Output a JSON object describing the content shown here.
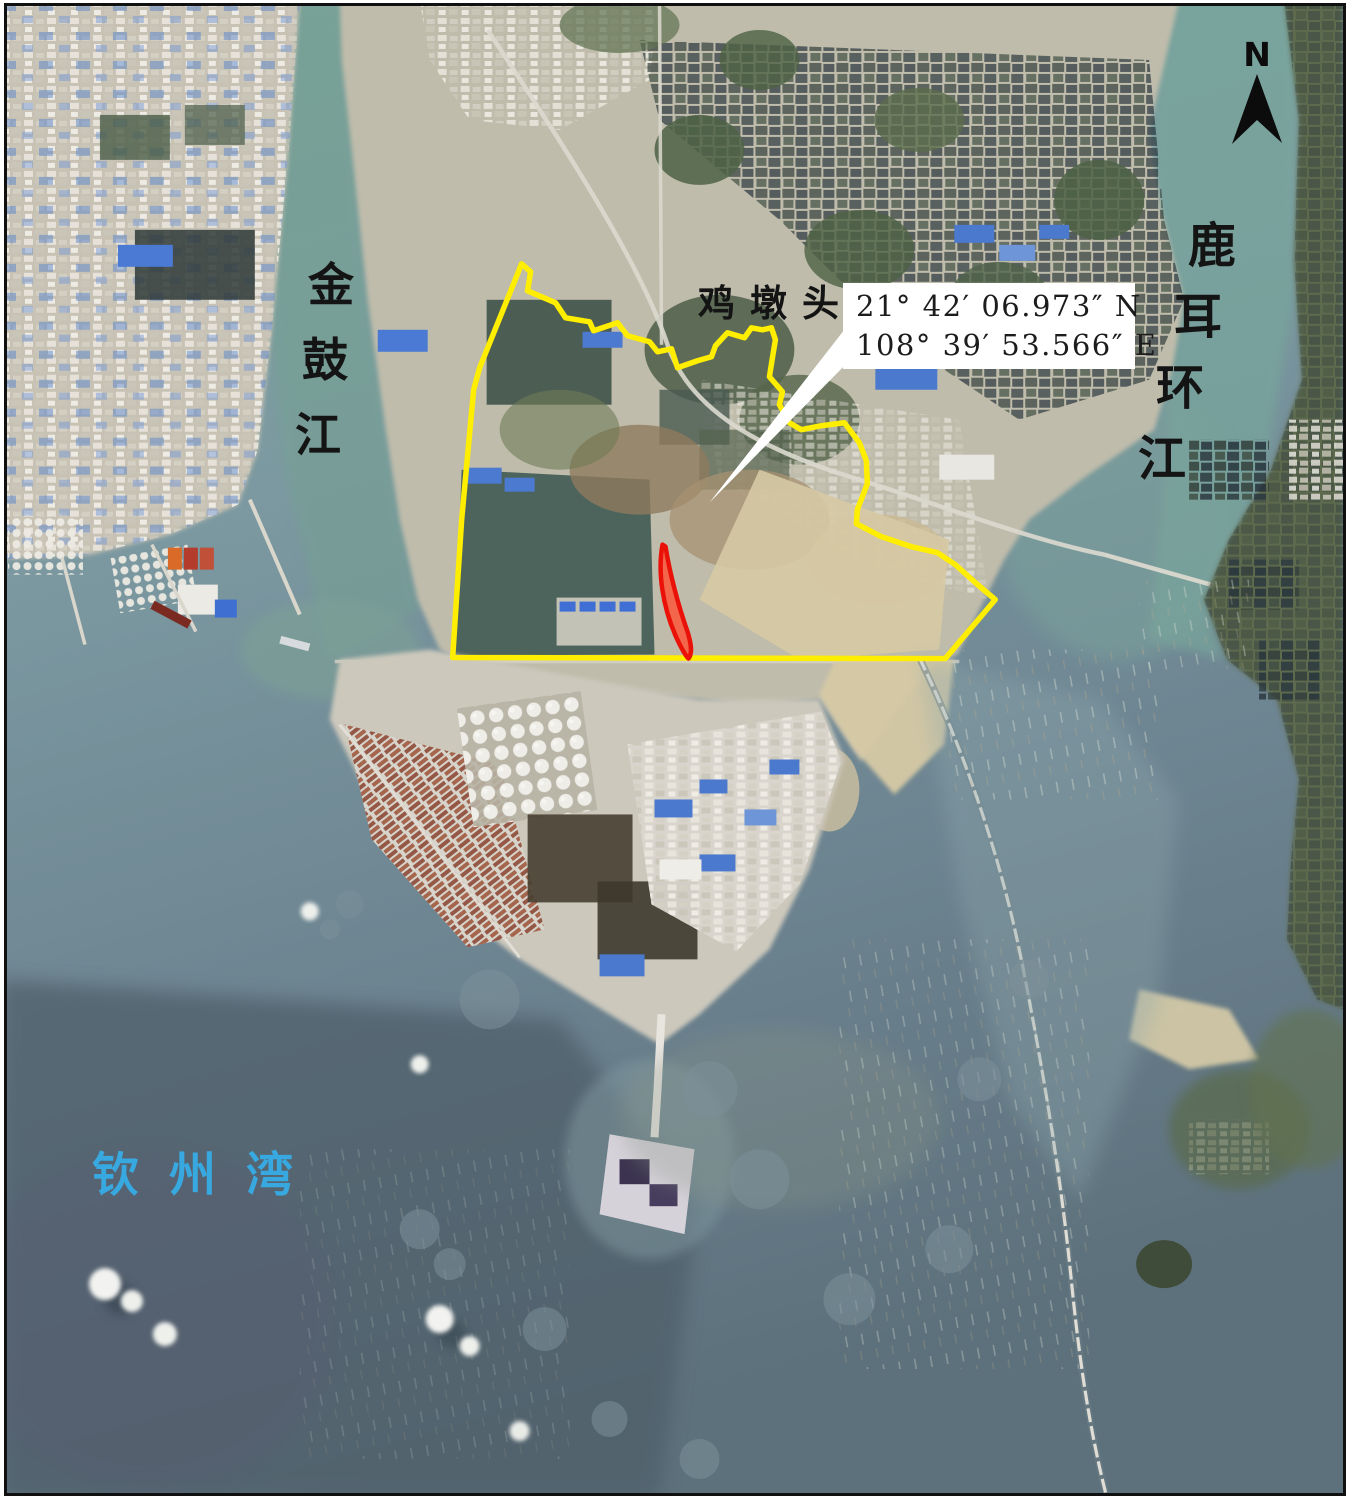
{
  "map": {
    "kind": "satellite-annotation-map",
    "callout": {
      "latitude": "21° 42′ 06.973″ N",
      "longitude": "108° 39′ 53.566″ E"
    },
    "labels": {
      "river_left": "金鼓江",
      "place_top": "鸡墩头",
      "river_right": "鹿耳环江",
      "bay": "钦州湾"
    },
    "north_arrow": {
      "label": "N"
    },
    "overlay": {
      "boundary_color": "#ffee00",
      "site_fill": "#f3664b",
      "site_stroke": "#ea1208",
      "leader_color": "#ffffff",
      "bay_label_color": "#38a9e0"
    }
  }
}
